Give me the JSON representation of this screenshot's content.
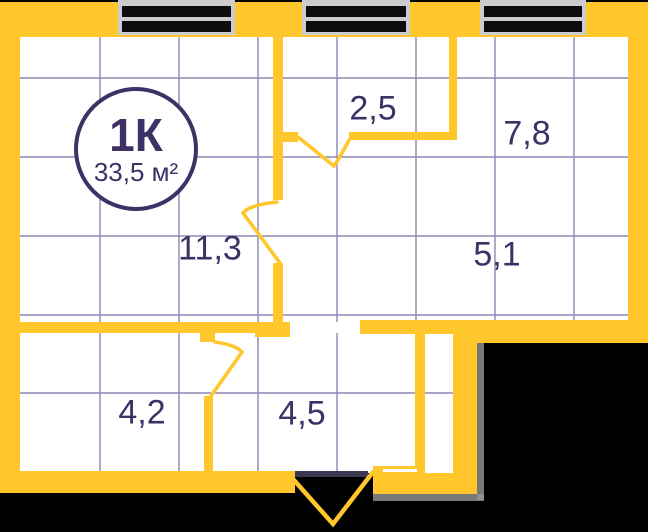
{
  "plan": {
    "type_badge": {
      "title": "1К",
      "area": "33,5 м²"
    },
    "rooms": [
      {
        "id": "hall-2-5",
        "area": "2,5"
      },
      {
        "id": "room-7-8",
        "area": "7,8"
      },
      {
        "id": "room-11-3",
        "area": "11,3"
      },
      {
        "id": "kitchen-5-1",
        "area": "5,1"
      },
      {
        "id": "room-4-2",
        "area": "4,2"
      },
      {
        "id": "corridor-4-5",
        "area": "4,5"
      }
    ],
    "colors": {
      "wall": "#FFC72C",
      "text": "#3E3166",
      "grid": "#8D87B3",
      "window_frame": "#CCCCCC",
      "window_glass": "#0D0D0D",
      "threshold": "#3B3850",
      "background": "#000000",
      "floor": "#FFFFFF"
    },
    "windows_count": 3
  }
}
